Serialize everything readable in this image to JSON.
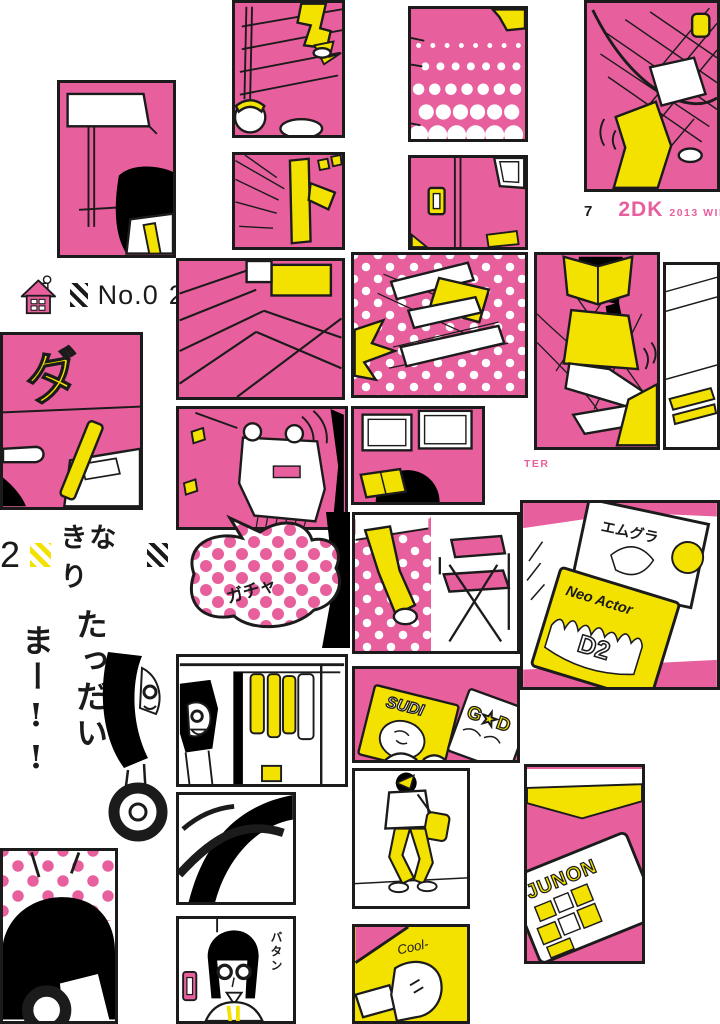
{
  "palette": {
    "pink": "#e85f9e",
    "yellow": "#f3e100",
    "ink": "#1b1b1b",
    "paper": "#ffffff"
  },
  "footer_top": {
    "page_number": "7",
    "brand": "2DK",
    "issue": "2013 WINT"
  },
  "footer_mid": {
    "issue_fragment": "TER"
  },
  "episode": {
    "number_prefix": "No.0",
    "number_digit": "2",
    "title": "きなり"
  },
  "speech": {
    "tadaima_col1": "たっだい",
    "tadaima_col2": "まー!!"
  },
  "sfx": {
    "da": "ダ",
    "gacha": "ガチャ",
    "batan": "バタン"
  },
  "covers": {
    "emugura": "エムグラ",
    "neo_actor": "Neo Actor",
    "neo_actor_code": "D2",
    "sudi": "SUDI",
    "g_star_d": "G★D",
    "junon": "JUNON",
    "cool": "Cool-"
  },
  "icons": {
    "house": "house-icon",
    "stripe_black": "black-stripe-badge",
    "stripe_yellow": "yellow-stripe-badge"
  }
}
